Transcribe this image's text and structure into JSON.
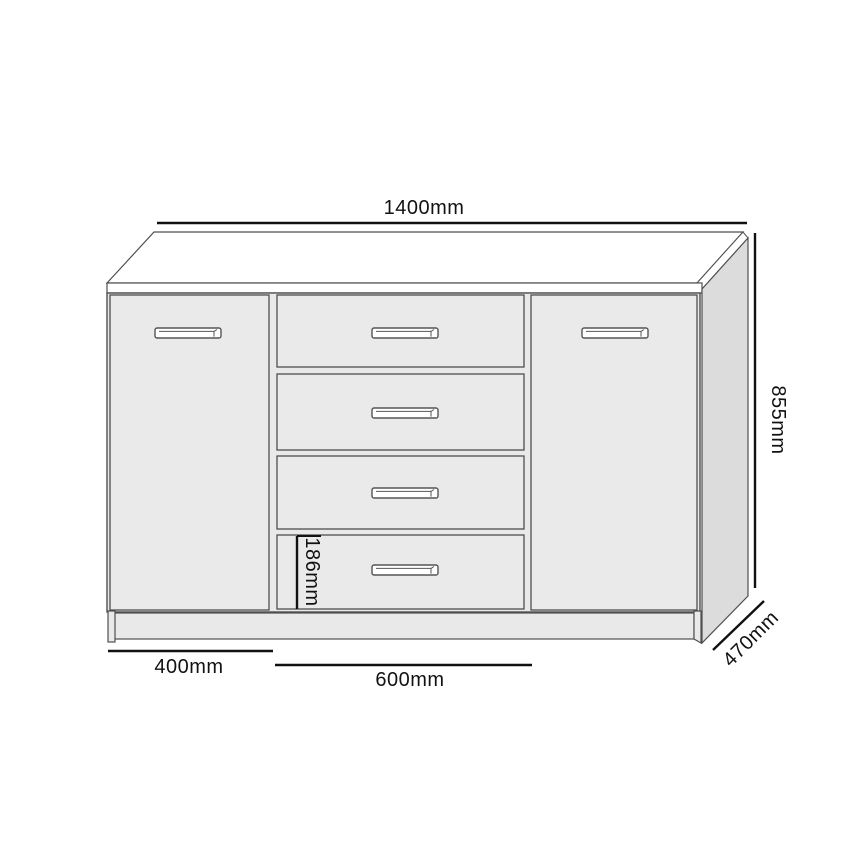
{
  "diagram": {
    "dimensions": {
      "overall_width": "1400mm",
      "overall_height": "855mm",
      "depth": "470mm",
      "door_width": "400mm",
      "drawer_width": "600mm",
      "drawer_height": "186mm"
    },
    "colors": {
      "background": "#ffffff",
      "top_fill": "#ffffff",
      "front_fill": "#e9e9e9",
      "side_fill": "#dcdcdc",
      "outline": "#4f4f4f",
      "dimension_line": "#111111",
      "label_text": "#121212"
    }
  }
}
